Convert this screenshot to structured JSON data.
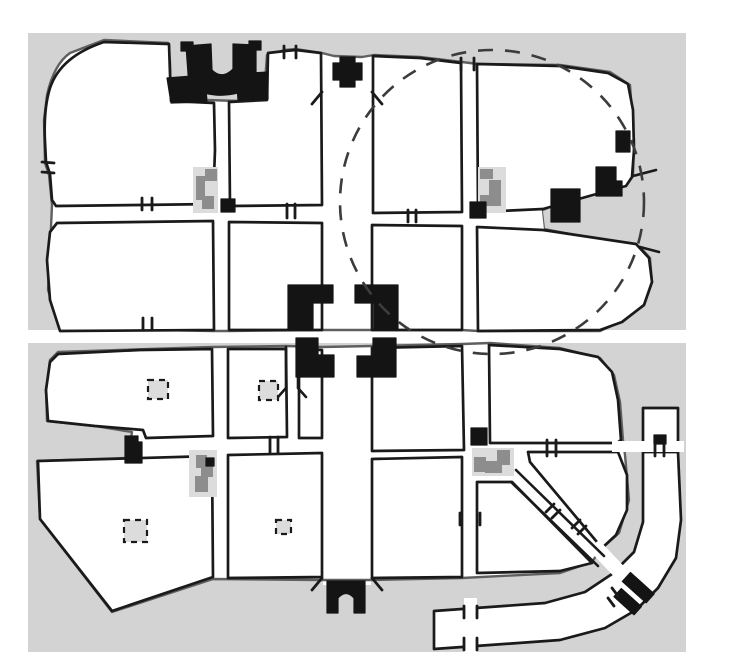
{
  "figure": {
    "kind": "hand-drawn schematic city plan",
    "visible_text": []
  },
  "colors": {
    "page_bg": "#ffffff",
    "canvas_bg": "#d3d3d3",
    "city_fill": "#ffffff",
    "wall_ink": "#1a1a1a",
    "outline_soft": "#5f5f5f",
    "monument_black": "#141414",
    "compound_light": "#dcdcdc",
    "compound_dark": "#8d8d8d",
    "dashed_ring": "#3c3c3c"
  },
  "features": [
    "upper-city-blob",
    "lower-city-blob",
    "orthogonal-street-grid",
    "main-north-south-street",
    "cross-axis-street-band",
    "theater-complex",
    "north-gate",
    "central-tetrapylon",
    "east-gate-plaza",
    "west-gate",
    "south-arch-gate",
    "dashed-circle-overlay",
    "diagonal-street",
    "southeast-gate",
    "east-corridor",
    "south-corridor-arm",
    "gray-courtyard-compounds",
    "small-courtyard-squares"
  ]
}
